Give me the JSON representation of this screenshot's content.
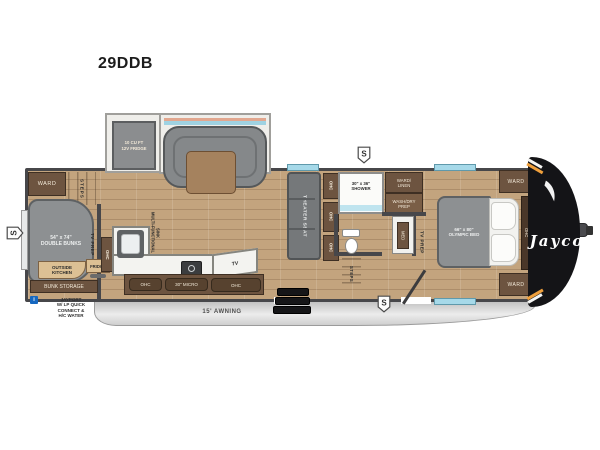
{
  "title": "29DDB",
  "labels": {
    "fridge_slide": "10 CU FT\n12V FRIDGE",
    "ward": "WARD",
    "steps": "STEPS",
    "double_bunks": "54\" x 74\"\nDOUBLE BUNKS",
    "tv_prep": "TV PREP",
    "outside_kitchen": "OUTSIDE\nKITCHEN",
    "outside_fridge": "FRIDGE",
    "bunk_storage": "BUNK STORAGE",
    "jayport_icon": "i",
    "jayport": "JAYPORT\nW/ LP QUICK\nCONNECT &\nH/C WATER",
    "ohc": "OHC",
    "multifunctional_sink": "MULTI-FUNCTIONAL\nSINK",
    "micro": "30\" MICRO",
    "tv": "TV",
    "theater_seat": "THEATER SEAT",
    "shower": "30\" x 36\"\nSHOWER",
    "ward_linen": "WARD/\nLINEN",
    "wash_dry_prep": "WASH/DRY\nPREP",
    "med": "MED",
    "olympic_bed": "66\" x 80\"\nOLYMPIC BED",
    "awning": "15' AWNING",
    "brand": "Jayco",
    "badge_s": "S"
  },
  "colors": {
    "wall": "#47474a",
    "cabinet": "#6d5440",
    "floor_wood": "#c3a47e",
    "furniture_gray": "#8d9092",
    "window_blue": "#a6d9e9",
    "front_cap": "#141417",
    "accent_orange": "#f0a03c",
    "jayport_blue": "#1668c0"
  }
}
